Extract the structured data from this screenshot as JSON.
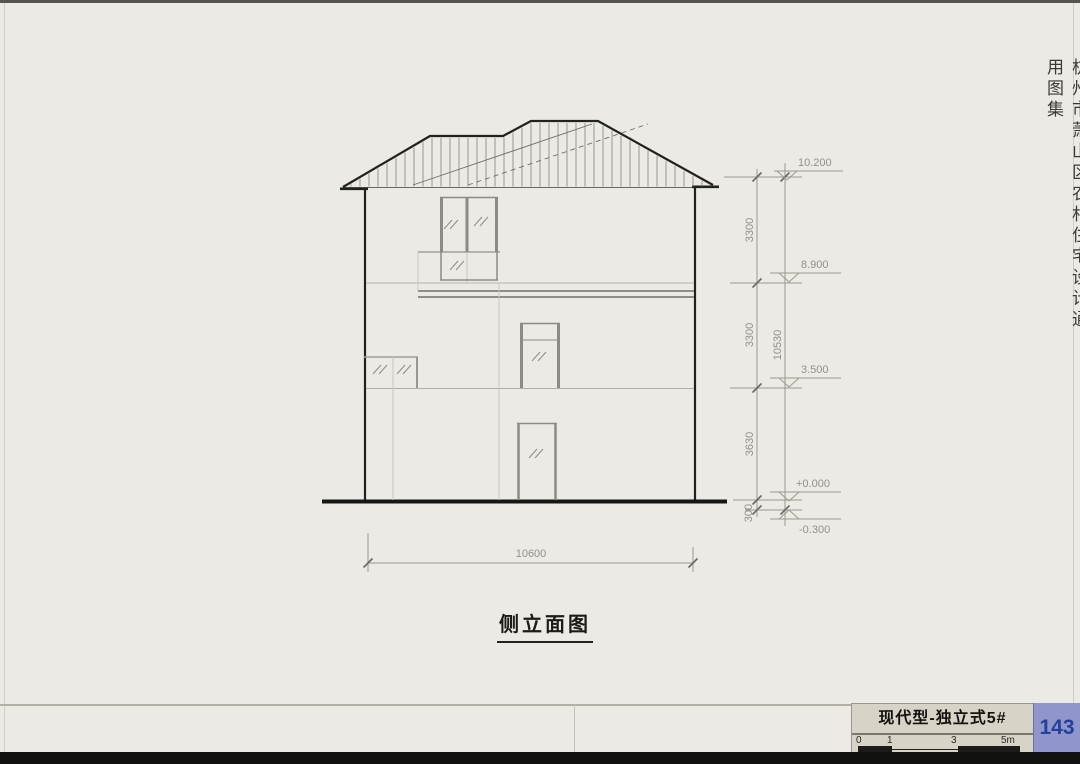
{
  "page": {
    "number": "143",
    "side_note": "杭州市萧山区农村住宅设计通用图集",
    "background_color": "#ebeae5",
    "page_number_box_color": "#9096c9",
    "page_number_text_color": "#23409e"
  },
  "drawing": {
    "title": "侧立面图",
    "width_dimension": "10600",
    "overall_height_dimension": "10530",
    "height_segments": [
      "3300",
      "3300",
      "3630",
      "300"
    ],
    "levels": [
      "10.200",
      "8.900",
      "3.500",
      "+0.000",
      "-0.300"
    ]
  },
  "title_block": {
    "title": "现代型-独立式5#",
    "scale_labels": [
      "0",
      "1",
      "3",
      "5m"
    ]
  }
}
